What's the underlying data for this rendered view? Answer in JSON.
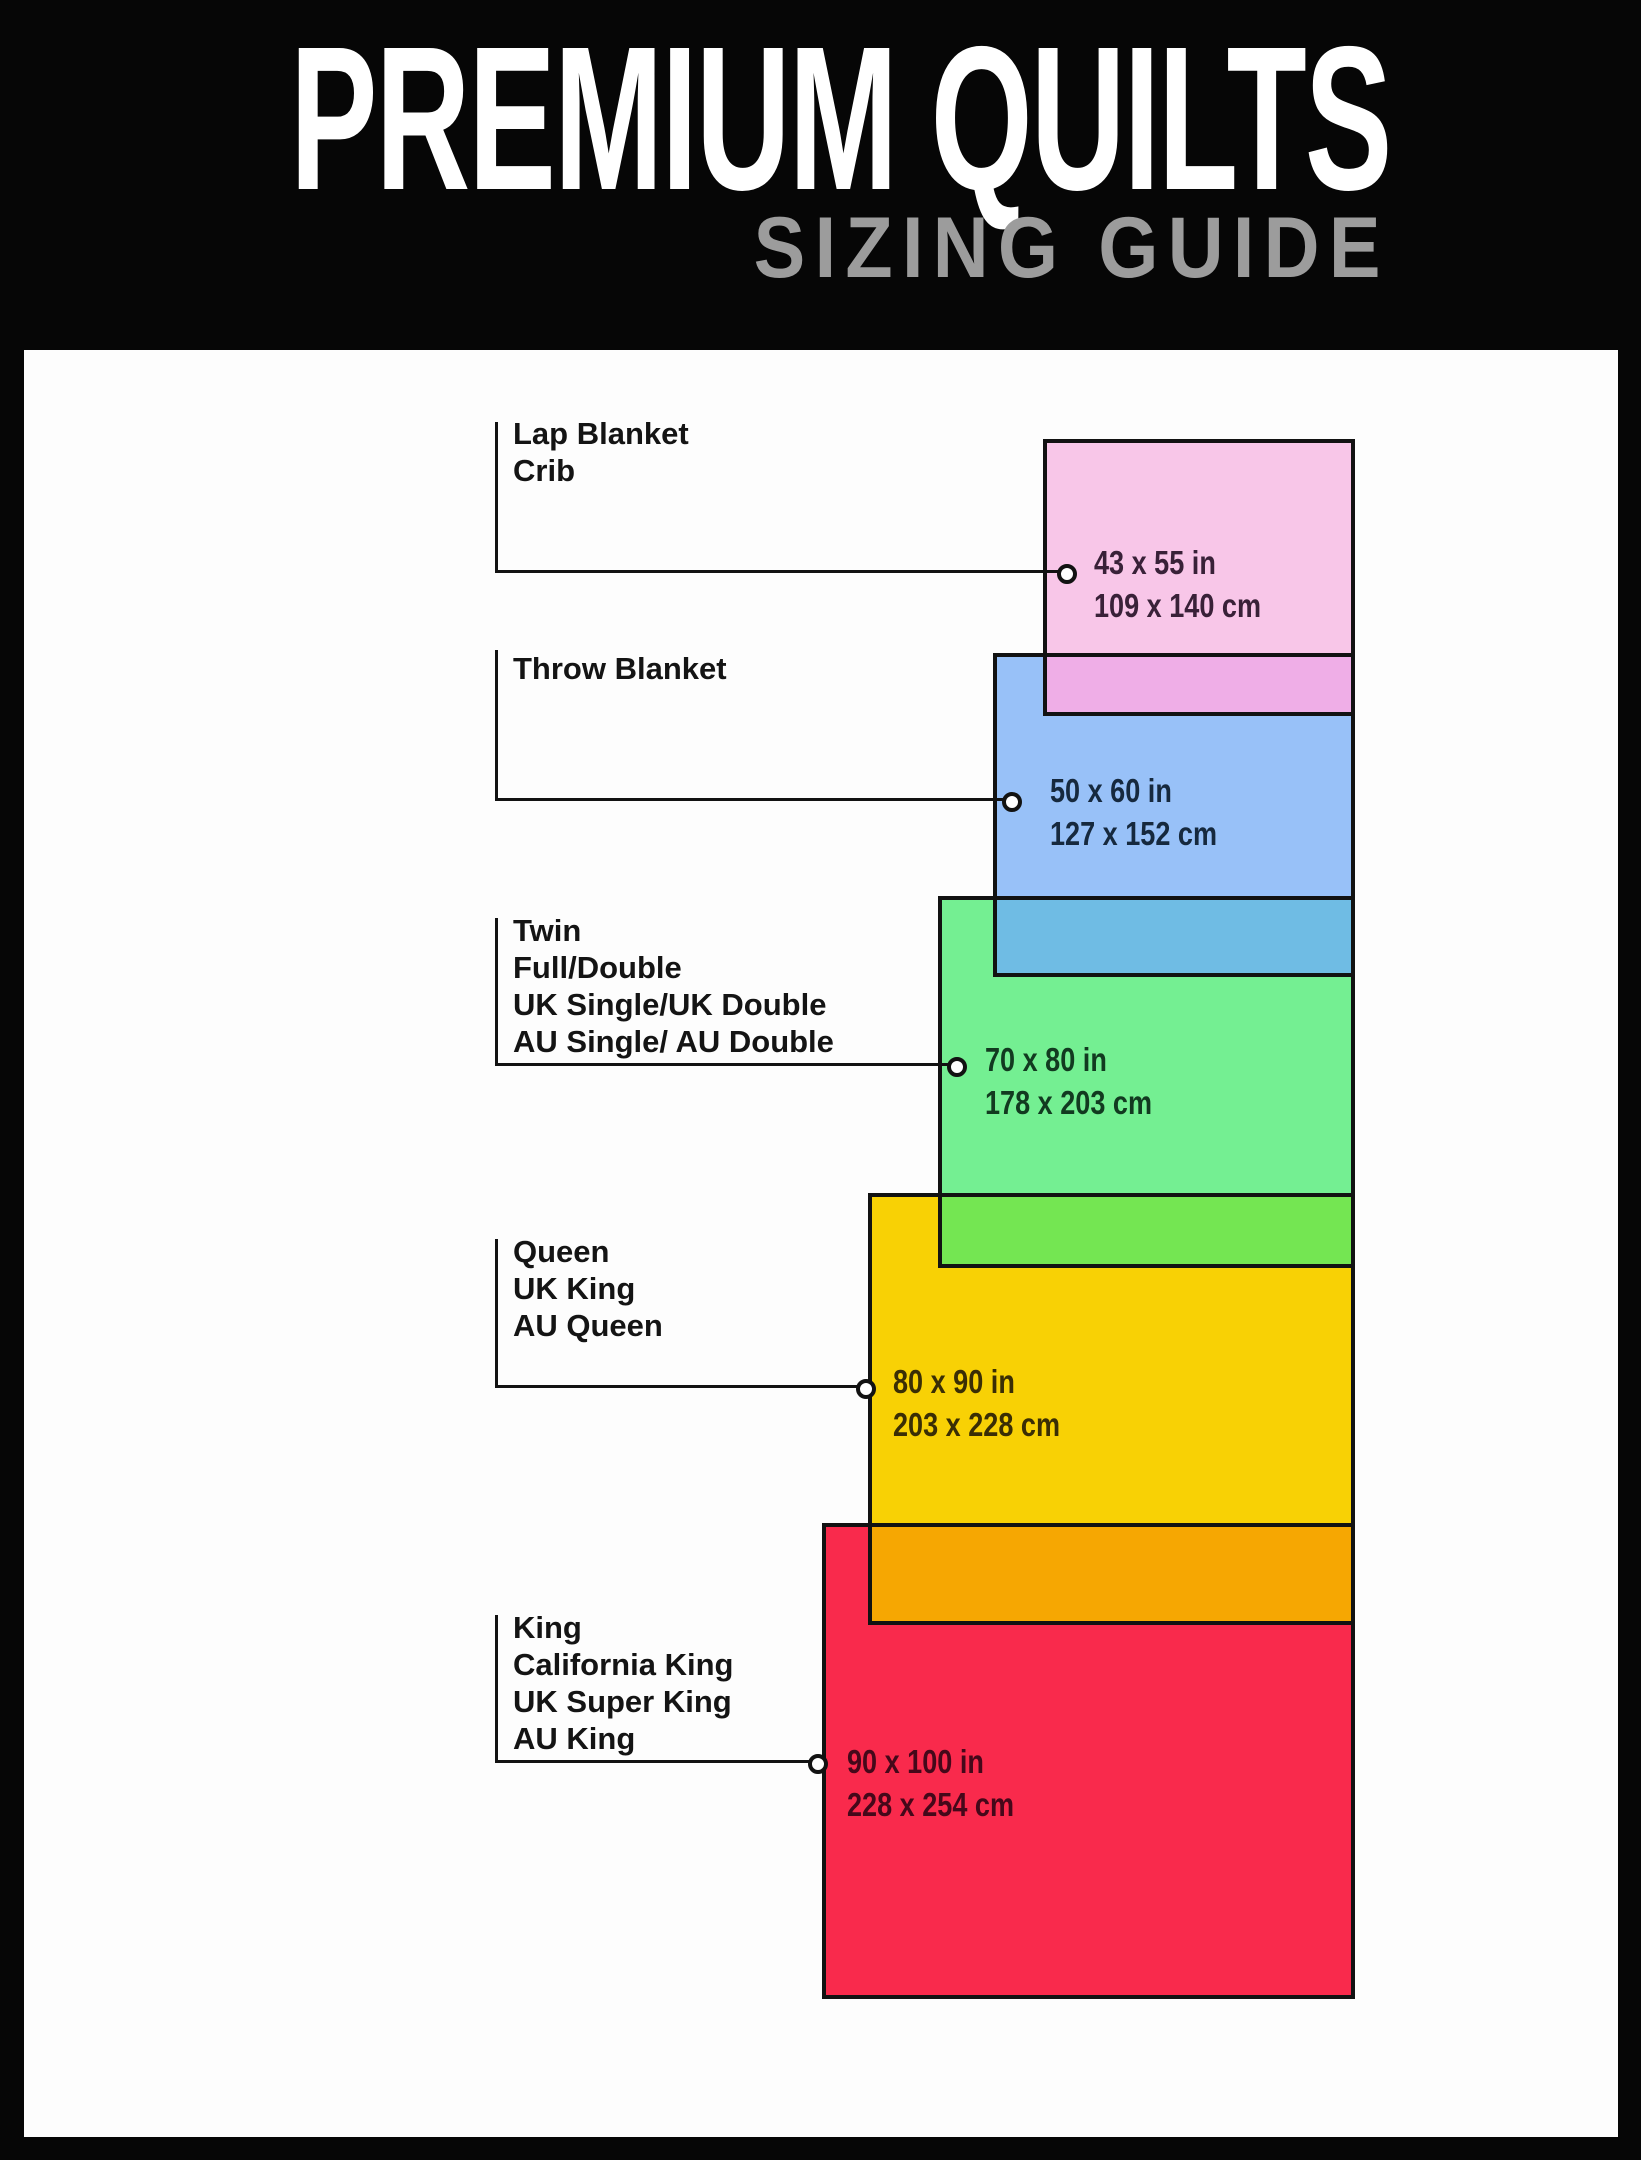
{
  "header": {
    "title": "PREMIUM QUILTS",
    "subtitle": "SIZING GUIDE"
  },
  "colors": {
    "frame_black": "#060606",
    "paper_white": "#FDFDFD",
    "line_black": "#121212",
    "title_white": "#FFFFFF",
    "subtitle_gray": "#9C9C9C",
    "label_black": "#141414"
  },
  "sizes": [
    {
      "id": "lap-blanket-crib",
      "labels": [
        "Lap Blanket",
        "Crib"
      ],
      "size_in": "43 x 55 in",
      "size_cm": "109 x 140 cm",
      "fill": "#F8C6E8",
      "text_color": "#392138"
    },
    {
      "id": "throw-blanket",
      "labels": [
        "Throw Blanket"
      ],
      "size_in": "50 x 60 in",
      "size_cm": "127 x 152 cm",
      "fill": "#98C1F8",
      "text_color": "#16293E"
    },
    {
      "id": "twin-full-double",
      "labels": [
        "Twin",
        "Full/Double",
        "UK Single/UK Double",
        "AU Single/ AU Double"
      ],
      "size_in": "70 x 80 in",
      "size_cm": "178 x 203 cm",
      "fill": "#74EF92",
      "text_color": "#123A20"
    },
    {
      "id": "queen",
      "labels": [
        "Queen",
        "UK King",
        "AU Queen"
      ],
      "size_in": "80 x 90 in",
      "size_cm": "203 x 228 cm",
      "fill": "#F8D105",
      "text_color": "#3A2E05"
    },
    {
      "id": "king",
      "labels": [
        "King",
        "California King",
        "UK Super King",
        "AU King"
      ],
      "size_in": "90 x 100 in",
      "size_cm": "228 x 254 cm",
      "fill": "#F92A4C",
      "text_color": "#45081A"
    }
  ],
  "overlaps": [
    {
      "between": "lap-over-throw",
      "fill": "#EFAEE7"
    },
    {
      "between": "throw-over-twin",
      "fill": "#6FBCE4"
    },
    {
      "between": "twin-over-queen",
      "fill": "#74E652"
    },
    {
      "between": "queen-over-king",
      "fill": "#F6A702"
    }
  ]
}
